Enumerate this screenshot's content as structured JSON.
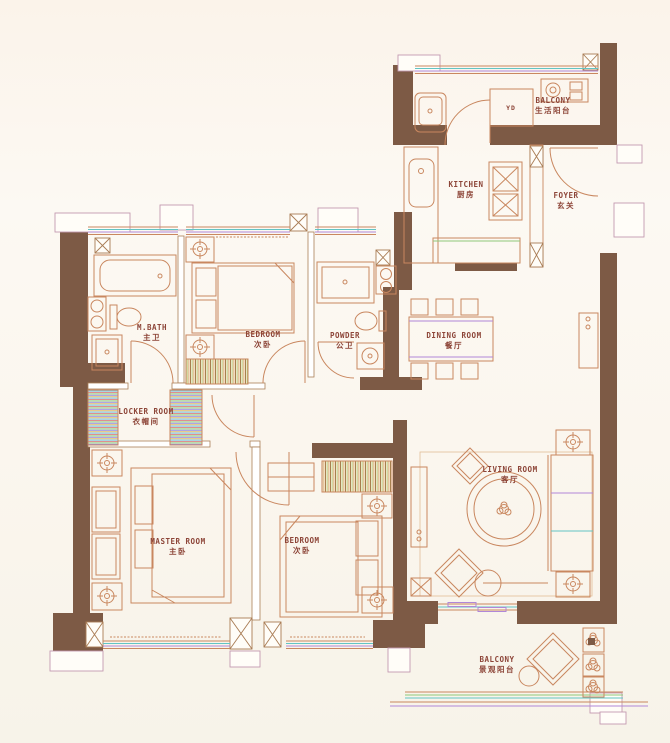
{
  "plan_title": "apartment floor plan",
  "colors": {
    "wall": "#7d5a45",
    "label": "#8d4538",
    "line_orange": "#c9875f",
    "accent_purple": "#b187d8",
    "accent_green": "#8fc87a",
    "accent_teal": "#62c4c4",
    "background": "#fbf6ee"
  },
  "rooms": [
    {
      "id": "balcony-top",
      "en": "BALCONY",
      "zh": "生活阳台"
    },
    {
      "id": "kitchen",
      "en": "KITCHEN",
      "zh": "厨房"
    },
    {
      "id": "foyer",
      "en": "FOYER",
      "zh": "玄关"
    },
    {
      "id": "dining",
      "en": "DINING ROOM",
      "zh": "餐厅"
    },
    {
      "id": "mbath",
      "en": "M.BATH",
      "zh": "主卫"
    },
    {
      "id": "bedroom-top",
      "en": "BEDROOM",
      "zh": "次卧"
    },
    {
      "id": "powder",
      "en": "POWDER",
      "zh": "公卫"
    },
    {
      "id": "locker",
      "en": "LOCKER ROOM",
      "zh": "衣帽间"
    },
    {
      "id": "master",
      "en": "MASTER ROOM",
      "zh": "主卧"
    },
    {
      "id": "bedroom2",
      "en": "BEDROOM",
      "zh": "次卧"
    },
    {
      "id": "living",
      "en": "LIVING ROOM",
      "zh": "客厅"
    },
    {
      "id": "balcony-bottom",
      "en": "BALCONY",
      "zh": "景观阳台"
    }
  ],
  "annotations": [
    {
      "id": "laundry",
      "text": "YD"
    }
  ]
}
